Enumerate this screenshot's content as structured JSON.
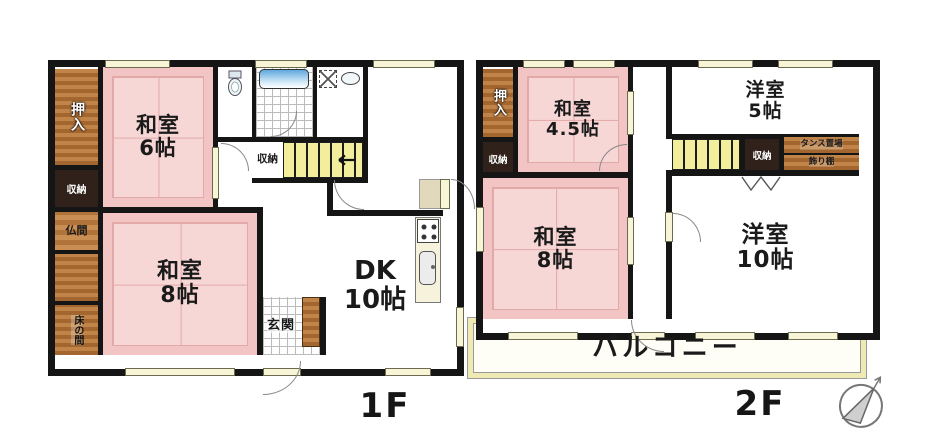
{
  "f1": {
    "label": "1F",
    "rooms": {
      "oshiire": "押入",
      "storage_left": "収納",
      "butsuma": "仏間",
      "tokonoma": "床の間",
      "washitsu6": {
        "name": "和室",
        "size": "6帖"
      },
      "washitsu8": {
        "name": "和室",
        "size": "8帖"
      },
      "storage_mid": "収納",
      "genkan": "玄関",
      "dk": {
        "name": "DK",
        "size": "10帖"
      }
    }
  },
  "f2": {
    "label": "2F",
    "rooms": {
      "oshiire": "押入",
      "storage_left": "収納",
      "washitsu45": {
        "name": "和室",
        "size": "4.5帖"
      },
      "washitsu8": {
        "name": "和室",
        "size": "8帖"
      },
      "yoshitsu5": {
        "name": "洋室",
        "size": "5帖"
      },
      "storage_mid": "収納",
      "tansu_okiba": "タンス置場",
      "kazaridana": "飾り棚",
      "yoshitsu10": {
        "name": "洋室",
        "size": "10帖"
      },
      "balcony": "バルコニー"
    }
  },
  "colors": {
    "wall": "#151515",
    "tatami": "#f2c4c4",
    "wood": "#b06b35",
    "stairs": "#f2ee9b",
    "window": "#f8f4d6",
    "bathtub": "#5fa8dd"
  }
}
